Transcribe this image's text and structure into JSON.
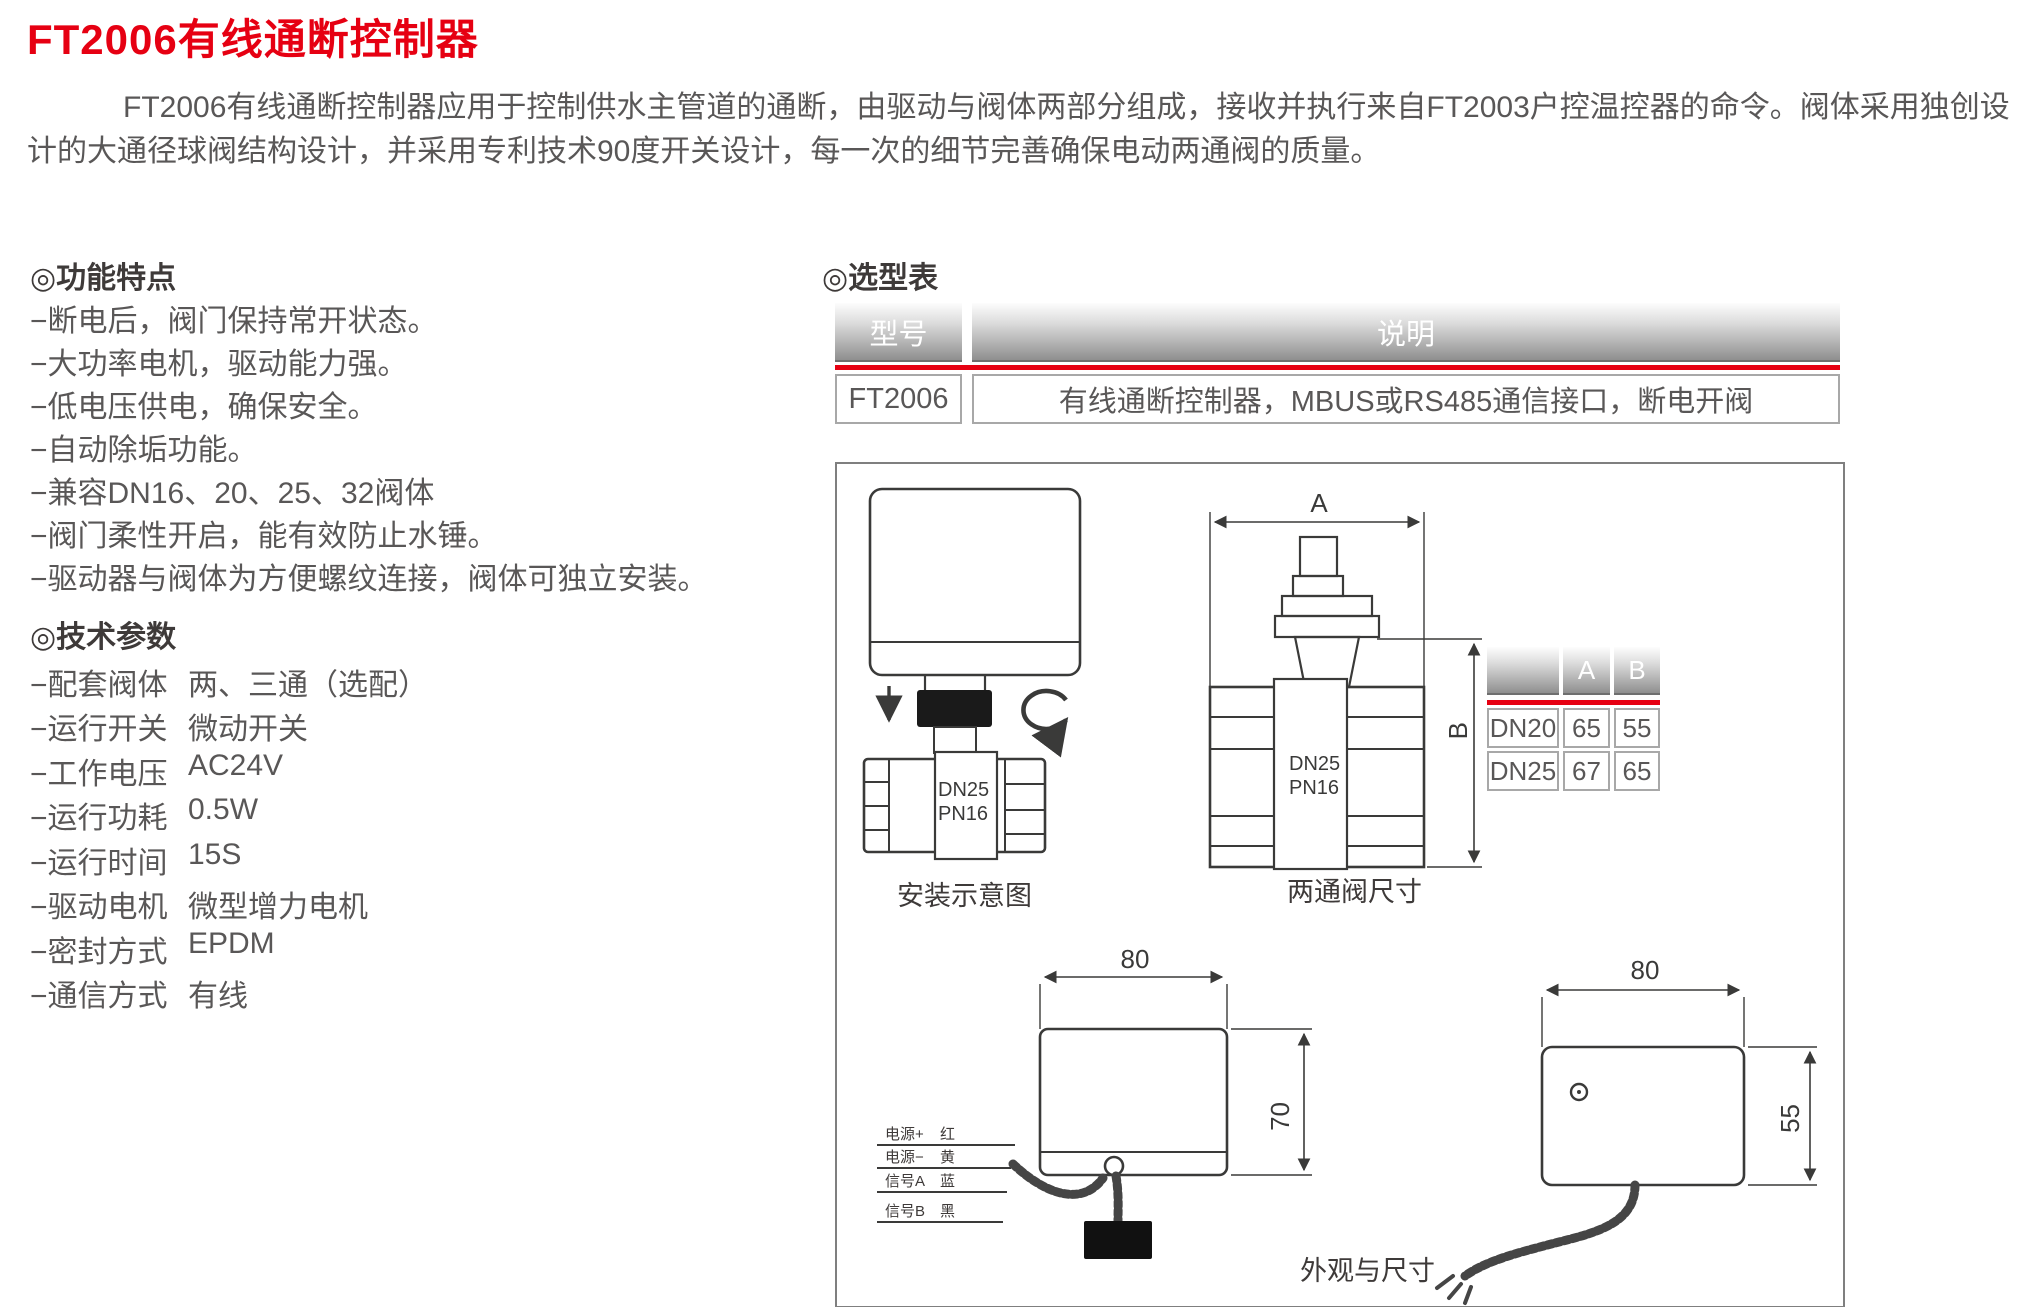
{
  "page": {
    "title": "FT2006有线通断控制器",
    "description": "FT2006有线通断控制器应用于控制供水主管道的通断，由驱动与阀体两部分组成，接收并执行来自FT2003户控温控器的命令。阀体采用独创设计的大通径球阀结构设计，并采用专利技术90度开关设计，每一次的细节完善确保电动两通阀的质量。"
  },
  "features": {
    "heading": "◎功能特点",
    "items": [
      "−断电后，阀门保持常开状态。",
      "−大功率电机，驱动能力强。",
      "−低电压供电，确保安全。",
      "−自动除垢功能。",
      "−兼容DN16、20、25、32阀体",
      "−阀门柔性开启，能有效防止水锤。",
      "−驱动器与阀体为方便螺纹连接，阀体可独立安装。"
    ]
  },
  "specs": {
    "heading": "◎技术参数",
    "rows": [
      {
        "label": "−配套阀体",
        "value": "两、三通（选配）"
      },
      {
        "label": "−运行开关",
        "value": "微动开关"
      },
      {
        "label": "−工作电压",
        "value": "AC24V"
      },
      {
        "label": "−运行功耗",
        "value": "0.5W"
      },
      {
        "label": "−运行时间",
        "value": "15S"
      },
      {
        "label": "−驱动电机",
        "value": "微型增力电机"
      },
      {
        "label": "−密封方式",
        "value": "EPDM"
      },
      {
        "label": "−通信方式",
        "value": "有线"
      }
    ]
  },
  "selection_table": {
    "heading": "◎选型表",
    "columns": [
      "型号",
      "说明"
    ],
    "rows": [
      {
        "model": "FT2006",
        "description": "有线通断控制器，MBUS或RS485通信接口，断电开阀"
      }
    ]
  },
  "diagram": {
    "install": {
      "caption": "安装示意图",
      "valve_dn": "DN25",
      "valve_pn": "PN16"
    },
    "valve_dims": {
      "caption": "两通阀尺寸",
      "dim_a": "A",
      "dim_b": "B",
      "valve_dn": "DN25",
      "valve_pn": "PN16"
    },
    "size_table": {
      "corner": "",
      "col_a": "A",
      "col_b": "B",
      "rows": [
        [
          "DN20",
          "65",
          "55"
        ],
        [
          "DN25",
          "67",
          "65"
        ]
      ]
    },
    "side_view": {
      "width_dim": "80",
      "height_dim": "70",
      "wires": [
        {
          "name": "电源+",
          "color": "红"
        },
        {
          "name": "电源−",
          "color": "黄"
        },
        {
          "name": "信号A",
          "color": "蓝"
        },
        {
          "name": "信号B",
          "color": "黑"
        }
      ]
    },
    "front_view": {
      "caption": "外观与尺寸",
      "width_dim": "80",
      "height_dim": "55"
    }
  },
  "colors": {
    "accent": "#e60012",
    "body_text": "#595757",
    "heading_text": "#3e3a39"
  }
}
